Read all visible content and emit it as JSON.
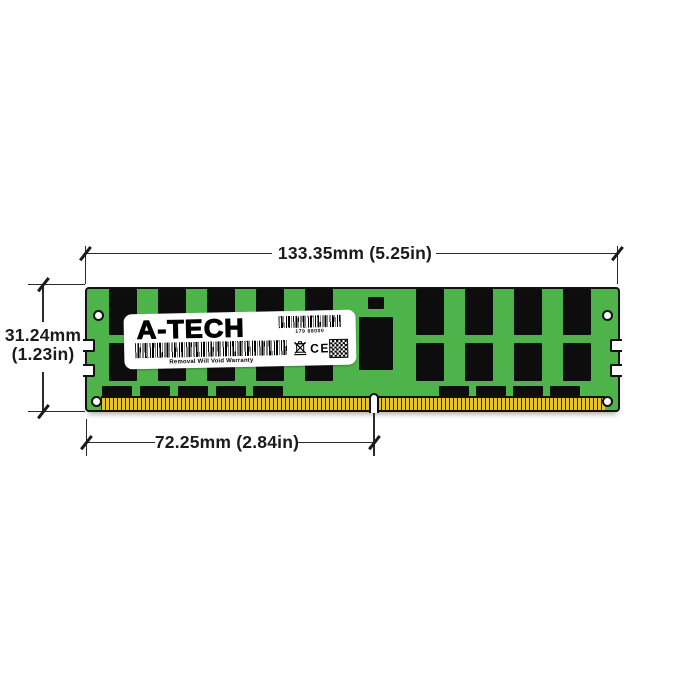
{
  "annotations": {
    "width_dim": "133.35mm (5.25in)",
    "height_dim_line1": "31.24mm",
    "height_dim_line2": "(1.23in)",
    "pin_dim": "72.25mm (2.84in)"
  },
  "label": {
    "brand": "A-TECH",
    "serial": "179 88000",
    "warranty": "Removal Will Void Warranty",
    "ce_mark": "CE"
  },
  "colors": {
    "pcb_green": "#4db34a",
    "chip_black": "#0d0d0d",
    "pin_gold": "#e5c331",
    "outline": "#111111",
    "dim_line": "#2b2b2b",
    "label_bg": "#ffffff"
  },
  "module_graphics": {
    "tall_chip_columns_left": [
      22,
      71,
      120,
      169,
      218
    ],
    "tall_chip_columns_right": [
      329,
      378,
      427,
      476
    ],
    "tall_chip_width": 28,
    "tall_chip_rows": [
      [
        0,
        46
      ],
      [
        54,
        38
      ]
    ],
    "small_chip_columns_left": [
      15,
      53,
      91,
      129,
      166
    ],
    "small_chip_columns_right": [
      352,
      389,
      426,
      463
    ],
    "small_chip_y": 97,
    "small_chip_width": 30,
    "small_chip_height": 10,
    "center_small_chip": [
      281,
      8,
      16,
      12
    ],
    "register_chip": [
      272,
      28,
      34,
      53
    ]
  }
}
